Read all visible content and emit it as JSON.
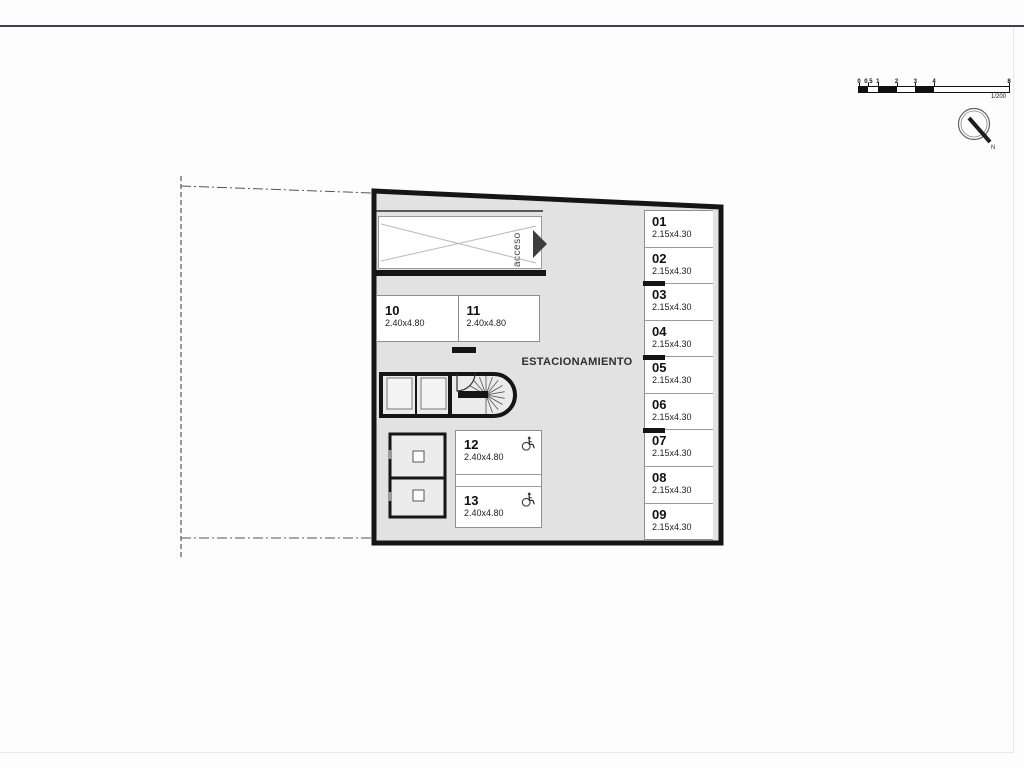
{
  "page": {
    "north_label": "N"
  },
  "scale_bar": {
    "max": 8,
    "ticks": [
      {
        "label": "0",
        "value": 0
      },
      {
        "label": "0.5",
        "value": 0.5
      },
      {
        "label": "1",
        "value": 1
      },
      {
        "label": "2",
        "value": 2
      },
      {
        "label": "3",
        "value": 3
      },
      {
        "label": "4",
        "value": 4
      },
      {
        "label": "8",
        "value": 8
      }
    ],
    "segments": [
      {
        "from": 0,
        "to": 0.5,
        "filled": true
      },
      {
        "from": 0.5,
        "to": 1,
        "filled": false
      },
      {
        "from": 1,
        "to": 2,
        "filled": true
      },
      {
        "from": 2,
        "to": 3,
        "filled": false
      },
      {
        "from": 3,
        "to": 4,
        "filled": true
      },
      {
        "from": 4,
        "to": 8,
        "filled": false
      }
    ],
    "ratio_label": "1/200"
  },
  "plan": {
    "area_label": "ESTACIONAMIENTO",
    "ramp_label": "acceso",
    "parking_right_column": [
      {
        "num": "01",
        "dims": "2.15x4.30"
      },
      {
        "num": "02",
        "dims": "2.15x4.30"
      },
      {
        "num": "03",
        "dims": "2.15x4.30"
      },
      {
        "num": "04",
        "dims": "2.15x4.30"
      },
      {
        "num": "05",
        "dims": "2.15x4.30"
      },
      {
        "num": "06",
        "dims": "2.15x4.30"
      },
      {
        "num": "07",
        "dims": "2.15x4.30"
      },
      {
        "num": "08",
        "dims": "2.15x4.30"
      },
      {
        "num": "09",
        "dims": "2.15x4.30"
      }
    ],
    "column_markers_after": [
      2,
      4,
      6
    ],
    "parking_island": [
      {
        "num": "10",
        "dims": "2.40x4.80"
      },
      {
        "num": "11",
        "dims": "2.40x4.80"
      }
    ],
    "parking_accessible": [
      {
        "num": "12",
        "dims": "2.40x4.80"
      },
      {
        "num": "13",
        "dims": "2.40x4.80"
      }
    ]
  }
}
